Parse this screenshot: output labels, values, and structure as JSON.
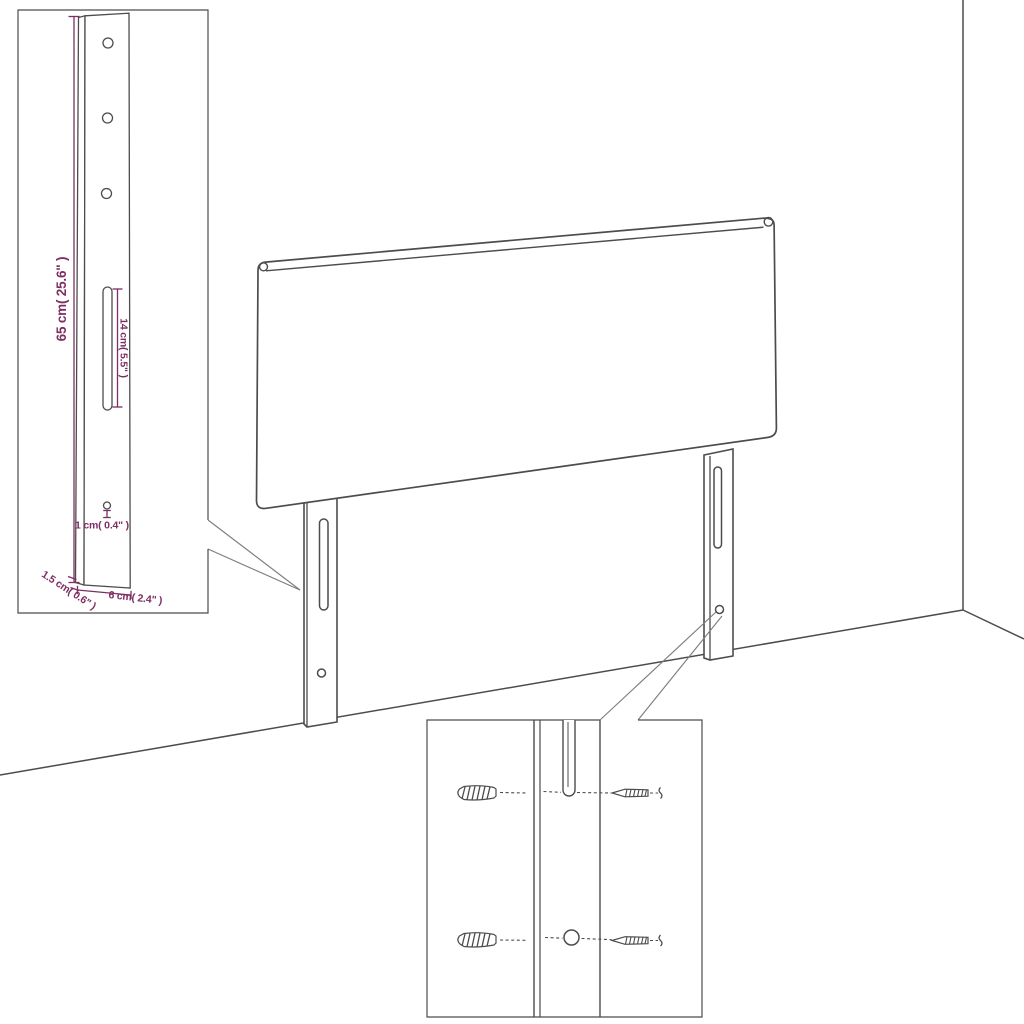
{
  "meta": {
    "title": "Headboard with legs - dimension diagram",
    "style": "technical line art product drawing"
  },
  "colors": {
    "line": "#4c4c4c",
    "dimension": "#7d2e62",
    "callout": "#7e7e7e",
    "background": "#ffffff"
  },
  "leg_detail_inset": {
    "height_label": "65 cm( 25.6\" )",
    "slot_label": "14 cm( 5.5\" )",
    "hole_label": "1 cm( 0.4\" )",
    "thickness_label": "1.5 cm( 0.6\" )",
    "width_label": "6 cm( 2.4\" )"
  },
  "scene_parts": {
    "headboard": "upholstered headboard panel",
    "left_leg": "mounting leg with slot and hole",
    "right_leg": "mounting leg with slot and hole",
    "room": "wall corner and floor lines"
  },
  "mounting_inset_parts": {
    "leg_channel": "leg front face with slot and hole",
    "anchors": [
      "wall-anchor-icon",
      "wall-anchor-icon"
    ],
    "screws": [
      "screw-icon",
      "screw-icon"
    ]
  }
}
